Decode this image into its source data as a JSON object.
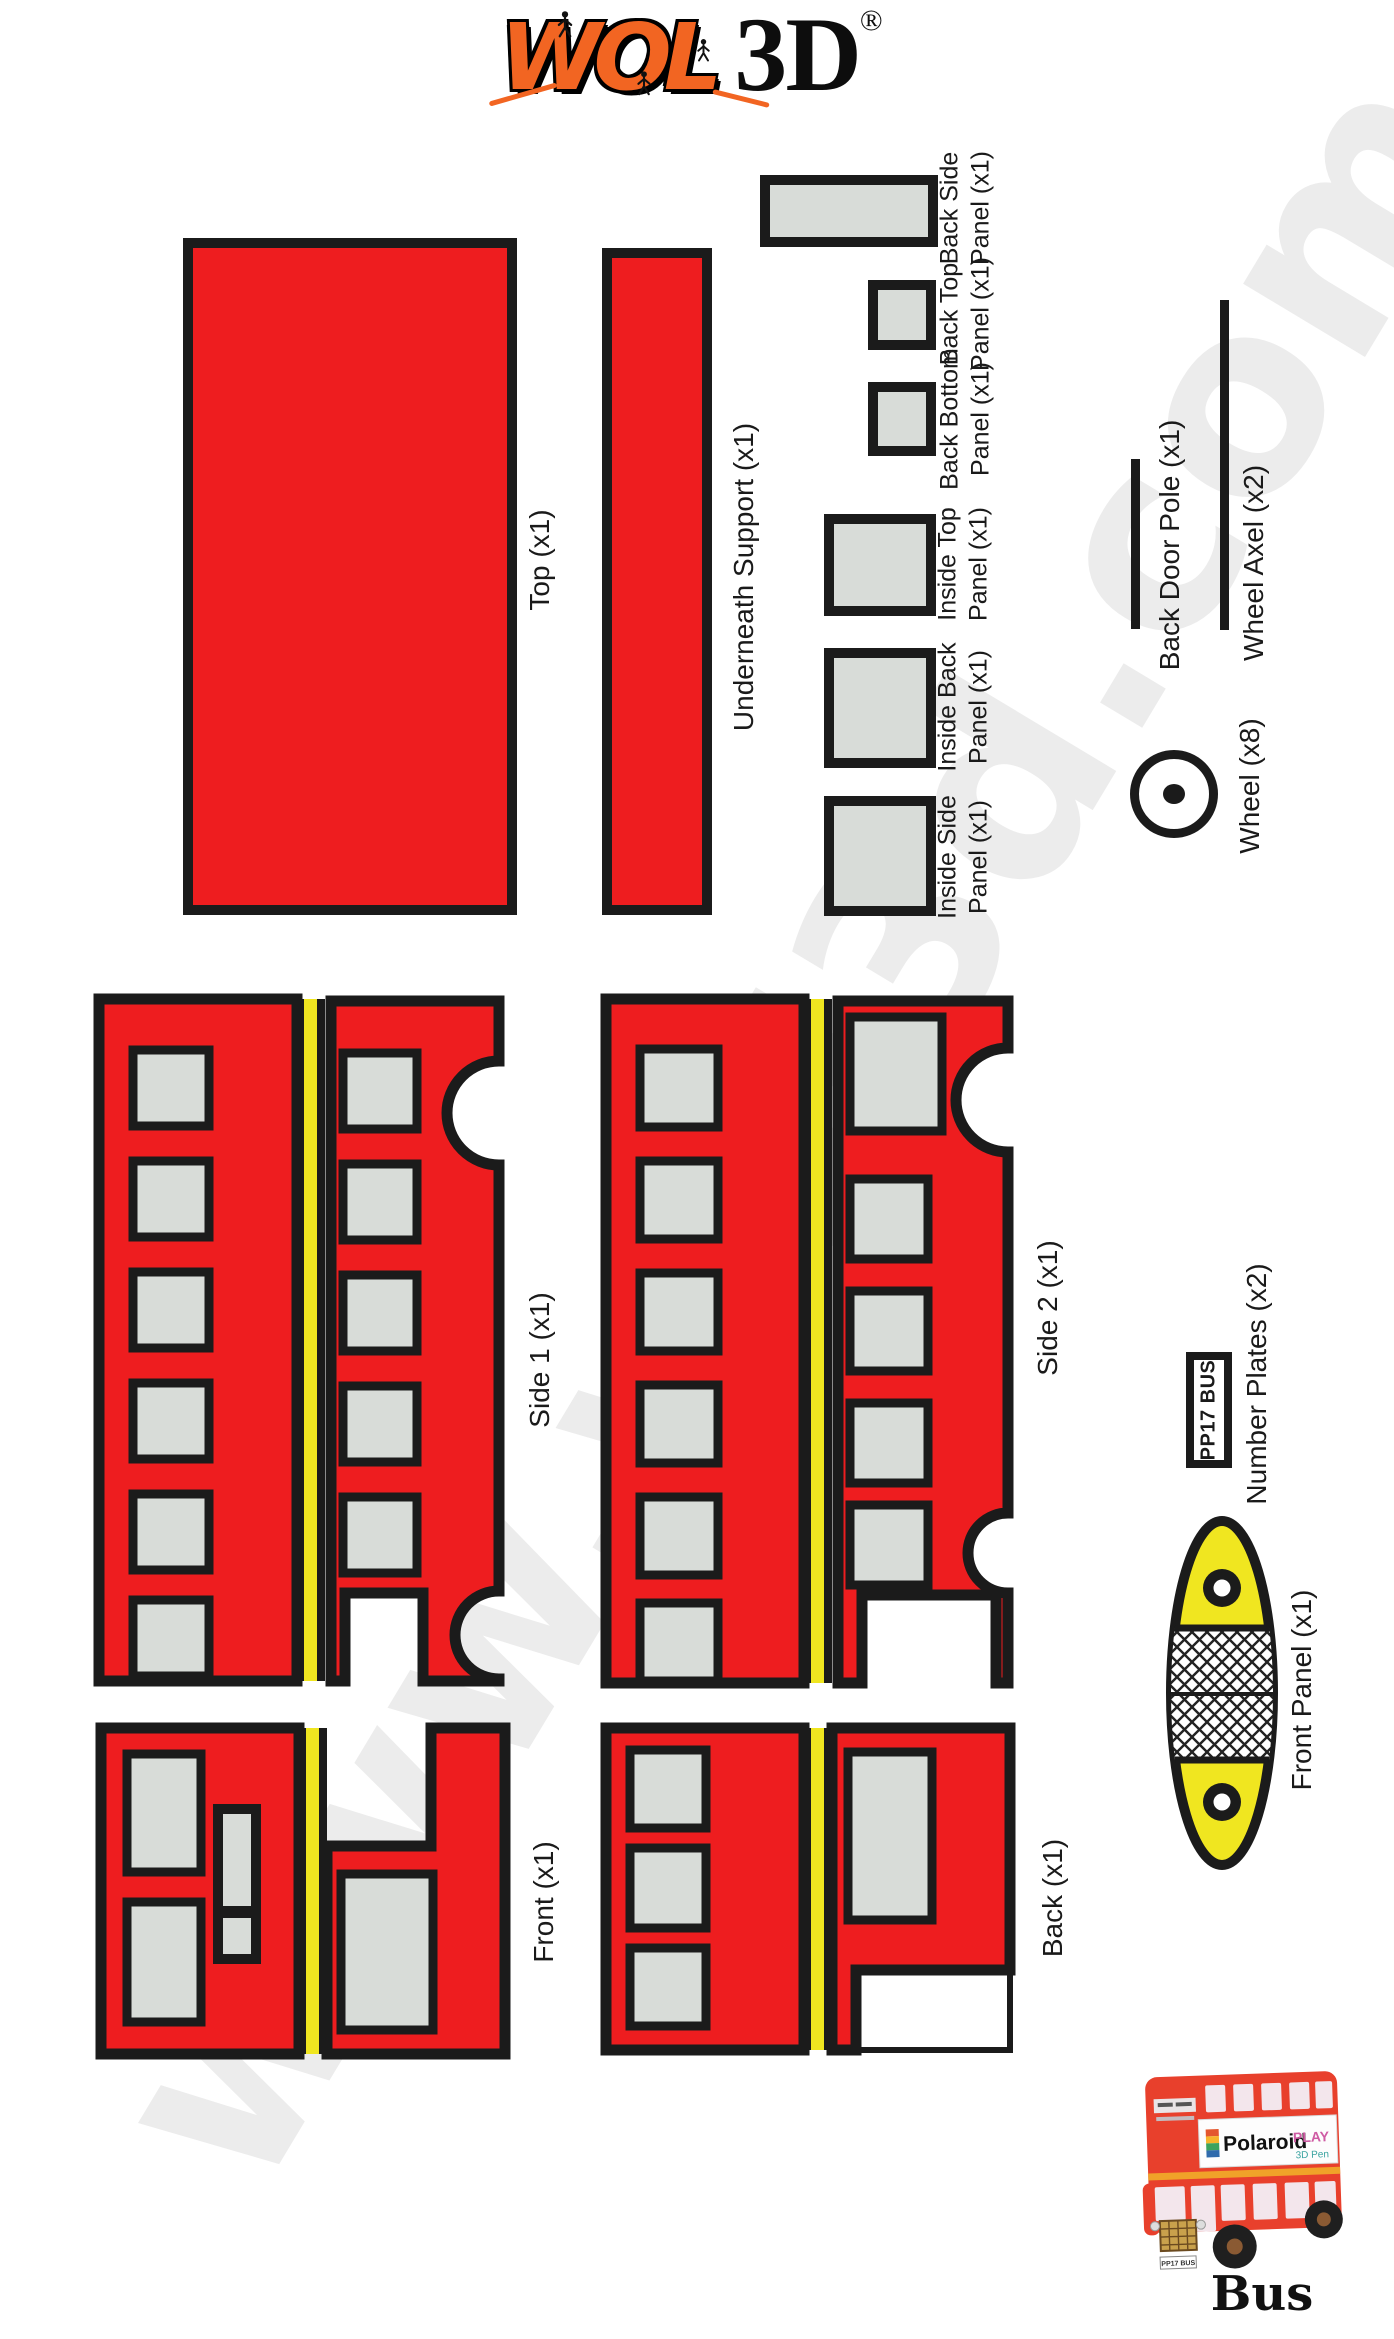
{
  "colors": {
    "red": "#ee1d1f",
    "yellow": "#f0e620",
    "panel_gray": "#d8dcd8",
    "outline_black": "#1b1b1b",
    "logo_orange": "#f26522",
    "watermark_gray": "#ececec",
    "bus_photo_red": "#e8402c",
    "bus_stripe_orange": "#f0a229"
  },
  "logo": {
    "wol": "WOL",
    "threed": "3D",
    "registered": "®"
  },
  "watermark": {
    "text": "www.wol3d.com"
  },
  "parts": {
    "top": {
      "label": "Top (x1)"
    },
    "underneath_support": {
      "label": "Underneath Support (x1)"
    },
    "back_side_panel": {
      "line1": "Back Side",
      "line2": "Panel (x1)"
    },
    "back_top_panel": {
      "line1": "Back Top",
      "line2": "Panel (x1)"
    },
    "back_bottom_panel": {
      "line1": "Back Bottom",
      "line2": "Panel (x1)"
    },
    "inside_top_panel": {
      "line1": "Inside Top",
      "line2": "Panel (x1)"
    },
    "inside_back_panel": {
      "line1": "Inside Back",
      "line2": "Panel (x1)"
    },
    "inside_side_panel": {
      "line1": "Inside Side",
      "line2": "Panel (x1)"
    },
    "back_door_pole": {
      "label": "Back Door Pole (x1)"
    },
    "wheel_axel": {
      "label": "Wheel Axel (x2)"
    },
    "wheel": {
      "label": "Wheel (x8)"
    },
    "side1": {
      "label": "Side 1 (x1)"
    },
    "side2": {
      "label": "Side 2 (x1)"
    },
    "number_plates": {
      "label": "Number Plates (x2)",
      "plate_text": "PP17 BUS"
    },
    "front_panel": {
      "label": "Front Panel (x1)"
    },
    "front": {
      "label": "Front (x1)"
    },
    "back": {
      "label": "Back (x1)"
    }
  },
  "bus_photo": {
    "caption": "Bus",
    "banner_brand": "Polaroid",
    "banner_play": "PLAY",
    "banner_sub": "3D Pen",
    "plate": "PP17 BUS"
  }
}
